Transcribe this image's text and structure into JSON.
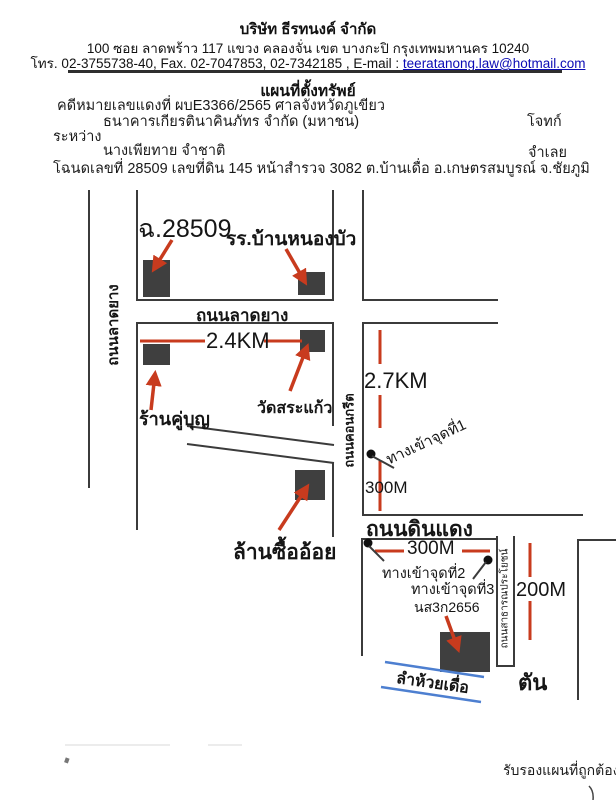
{
  "header": {
    "company": "บริษัท  ธีรทนงค์  จำกัด",
    "address": "100   ซอย ลาดพร้าว 117    แขวง คลองจั่น    เขต บางกะปิ   กรุงเทพมหานคร  10240",
    "phone_fax": "โทร. 02-3755738-40, Fax.  02-7047853, 02-7342185 , E-mail : ",
    "email": "teeratanong.law@hotmail.com"
  },
  "doc": {
    "title": "แผนที่ตั้งทรัพย์",
    "case_line": "คดีหมายเลขแดงที่ ผบE3366/2565 ศาลจังหวัดภูเขียว",
    "plaintiff": "ธนาคารเกียรตินาคินภัทร จำกัด (มหาชน)",
    "plaintiff_role": "โจทก์",
    "between": "ระหว่าง",
    "defendant": "นางเพียทาย จำชาติ",
    "defendant_role": "จำเลย",
    "deed_line": "โฉนดเลขที่ 28509 เลขที่ดิน 145 หน้าสำรวจ 3082 ต.บ้านเดื่อ อ.เกษตรสมบูรณ์  จ.ชัยภูมิ"
  },
  "map": {
    "chanote": "ฉ.28509",
    "school": "รร.บ้านหนองบัว",
    "road_latyang_vertical": "ถนนลาดยาง",
    "road_latyang_horizontal": "ถนนลาดยาง",
    "dist_24km": "2.4KM",
    "shop": "ร้านคู่บุญ",
    "temple": "วัดสระแก้ว",
    "road_concrete": "ถนนคอนกรีต",
    "dist_27km": "2.7KM",
    "entrance1": "ทางเข้าจุดที่1",
    "dist_300m_a": "300M",
    "road_dindaeng": "ถนนดินแดง",
    "dist_300m_b": "300M",
    "entrance2": "ทางเข้าจุดที่2",
    "entrance3": "ทางเข้าจุดที่3",
    "deed_small": "นส3ก2656",
    "road_public": "ถนนสาธารณประโยชน์",
    "dist_200m": "200M",
    "sugarcane_yard": "ล้านซื้ออ้อย",
    "stream": "ลำห้วยเดื่อ",
    "dead_end": "ตัน"
  },
  "footer": {
    "certify": "รับรองแผนที่ถูกต้อง"
  },
  "colors": {
    "accent_red": "#c83b1e",
    "road_black": "#3b3b3b",
    "stream_blue": "#4d7fd0",
    "link_blue": "#0b0bb5"
  }
}
